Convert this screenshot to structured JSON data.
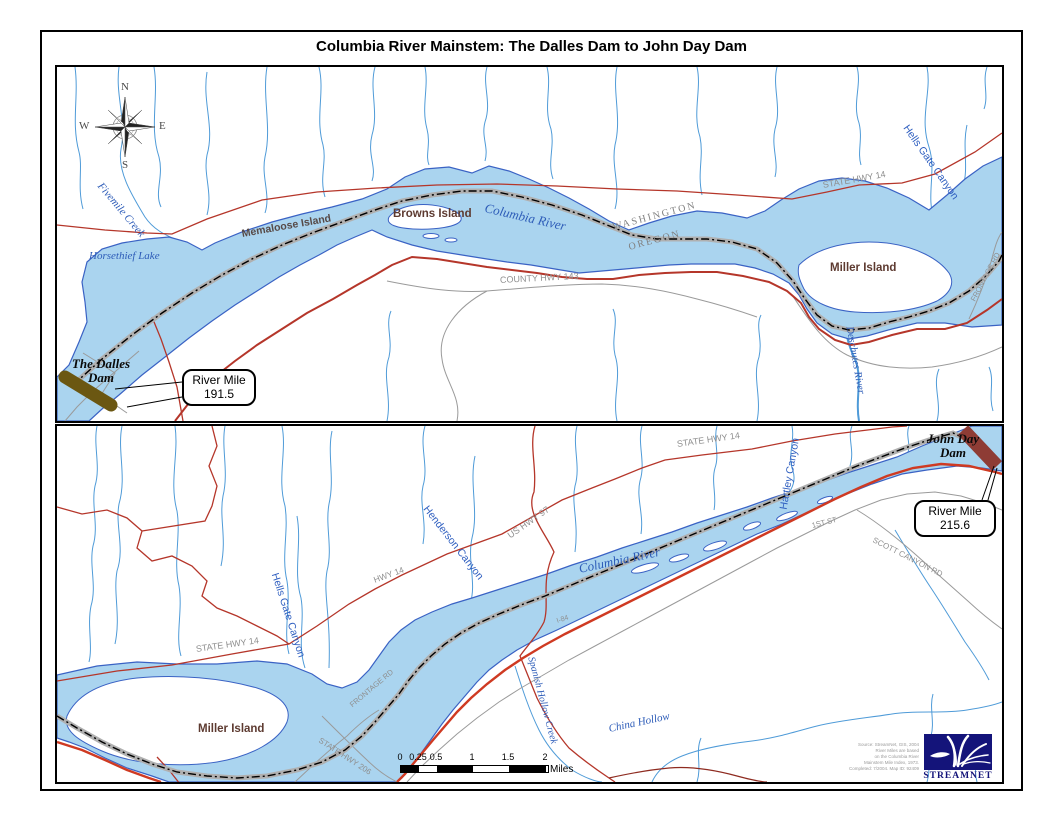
{
  "title": "Columbia River Mainstem: The Dalles Dam to John Day Dam",
  "compass": {
    "north": "N",
    "east": "E",
    "south": "S",
    "west": "W"
  },
  "colors": {
    "river_fill": "#aad4ef",
    "river_outline": "#3a62c4",
    "stream_blue": "#4f9bd8",
    "highway_red": "#b5362a",
    "interstate_red": "#cf3a22",
    "road_gray": "#9a9a9a",
    "mainstem_route_dash": "#000000",
    "mainstem_route_casing": "#b0b0b0",
    "island_label": "#5d3a30",
    "water_label": "#2d5cb8",
    "road_label_gray": "#8f8f8f",
    "state_label_gray": "#808080",
    "the_dalles_dam_color": "#6b5712",
    "john_day_dam_color": "#8e3c35",
    "logo_navy": "#14147a"
  },
  "top_panel": {
    "labels": {
      "fivemile_creek": "Fivemile Creek",
      "horsethief_lake": "Horsethief Lake",
      "memaloose_island": "Memaloose Island",
      "browns_island": "Browns Island",
      "columbia_river": "Columbia River",
      "washington": "WASHINGTON",
      "oregon": "OREGON",
      "county_hwy_143": "COUNTY HWY 143",
      "state_hwy_14": "STATE HWY 14",
      "hells_gate_canyon": "Hells Gate Canyon",
      "miller_island": "Miller Island",
      "frontage_rd": "FRONTAGE RD",
      "deschutes_river": "Deschutes River",
      "dam_line1": "The Dalles",
      "dam_line2": "Dam"
    },
    "callout": {
      "line1": "River Mile",
      "line2": "191.5"
    }
  },
  "bottom_panel": {
    "labels": {
      "state_hwy_14_north": "STATE HWY 14",
      "state_hwy_14_west": "STATE HWY 14",
      "hwy_14": "HWY 14",
      "henderson_canyon": "Henderson Canyon",
      "hells_gate_canyon": "Hells Gate Canyon",
      "hartley_canyon": "Hartley Canyon",
      "us_hwy_97": "US HWY 97",
      "columbia_river": "Columbia River",
      "i_84": "I-84",
      "first_st": "1ST ST",
      "scott_canyon_rd": "SCOTT CANYON RD",
      "state_hwy_206": "STATE HWY 206",
      "frontage_rd": "FRONTAGE RD",
      "miller_island": "Miller Island",
      "spanish_hollow_creek": "Spanish Hollow Creek",
      "china_hollow": "China Hollow",
      "dam_line1": "John Day",
      "dam_line2": "Dam"
    },
    "callout": {
      "line1": "River Mile",
      "line2": "215.6"
    }
  },
  "scale_bar": {
    "ticks": [
      "0",
      "0.25",
      "0.5",
      "1",
      "1.5",
      "2"
    ],
    "unit": "Miles"
  },
  "logo": {
    "text": "STREAMNET"
  },
  "attribution": {
    "line1": "Source: StreamNet, GIS, 2004",
    "line2": "River Miles are based",
    "line3": "on the Columbia River",
    "line4": "Mainstem Mile Index, 1973.",
    "line5": "Completed: 7/2004.  Map ID: 92409"
  }
}
